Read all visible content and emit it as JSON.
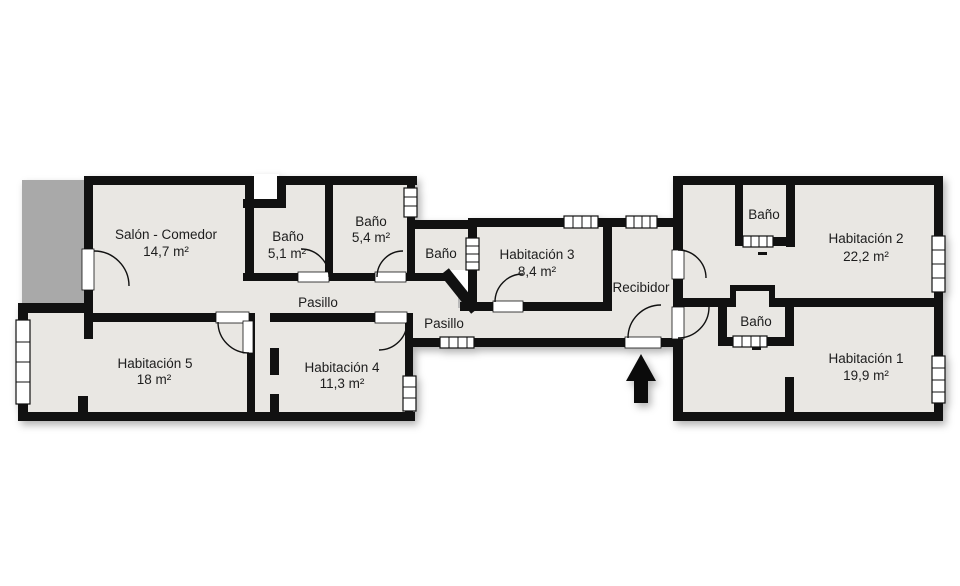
{
  "plan": {
    "rooms": {
      "salon": {
        "name": "Salón - Comedor",
        "area": "14,7 m²"
      },
      "bano_51": {
        "name": "Baño",
        "area": "5,1 m²"
      },
      "bano_54": {
        "name": "Baño",
        "area": "5,4 m²"
      },
      "bano_mid": {
        "name": "Baño"
      },
      "hab3": {
        "name": "Habitación 3",
        "area": "8,4 m²"
      },
      "recibidor": {
        "name": "Recibidor"
      },
      "bano_top_right": {
        "name": "Baño"
      },
      "hab2": {
        "name": "Habitación 2",
        "area": "22,2 m²"
      },
      "bano_bottom_right": {
        "name": "Baño"
      },
      "hab1": {
        "name": "Habitación 1",
        "area": "19,9 m²"
      },
      "hab5": {
        "name": "Habitación 5",
        "area": "18 m²"
      },
      "hab4": {
        "name": "Habitación 4",
        "area": "11,3 m²"
      },
      "pasillo_left": {
        "name": "Pasillo"
      },
      "pasillo_right": {
        "name": "Pasillo"
      }
    },
    "icons": {
      "entrance_arrow": "filled-up-arrow"
    },
    "colors": {
      "background": "#ffffff",
      "floor": "#e9e7e3",
      "wall": "#111111",
      "balcony": "#a9a9a9",
      "text": "#1d1d1d"
    }
  }
}
